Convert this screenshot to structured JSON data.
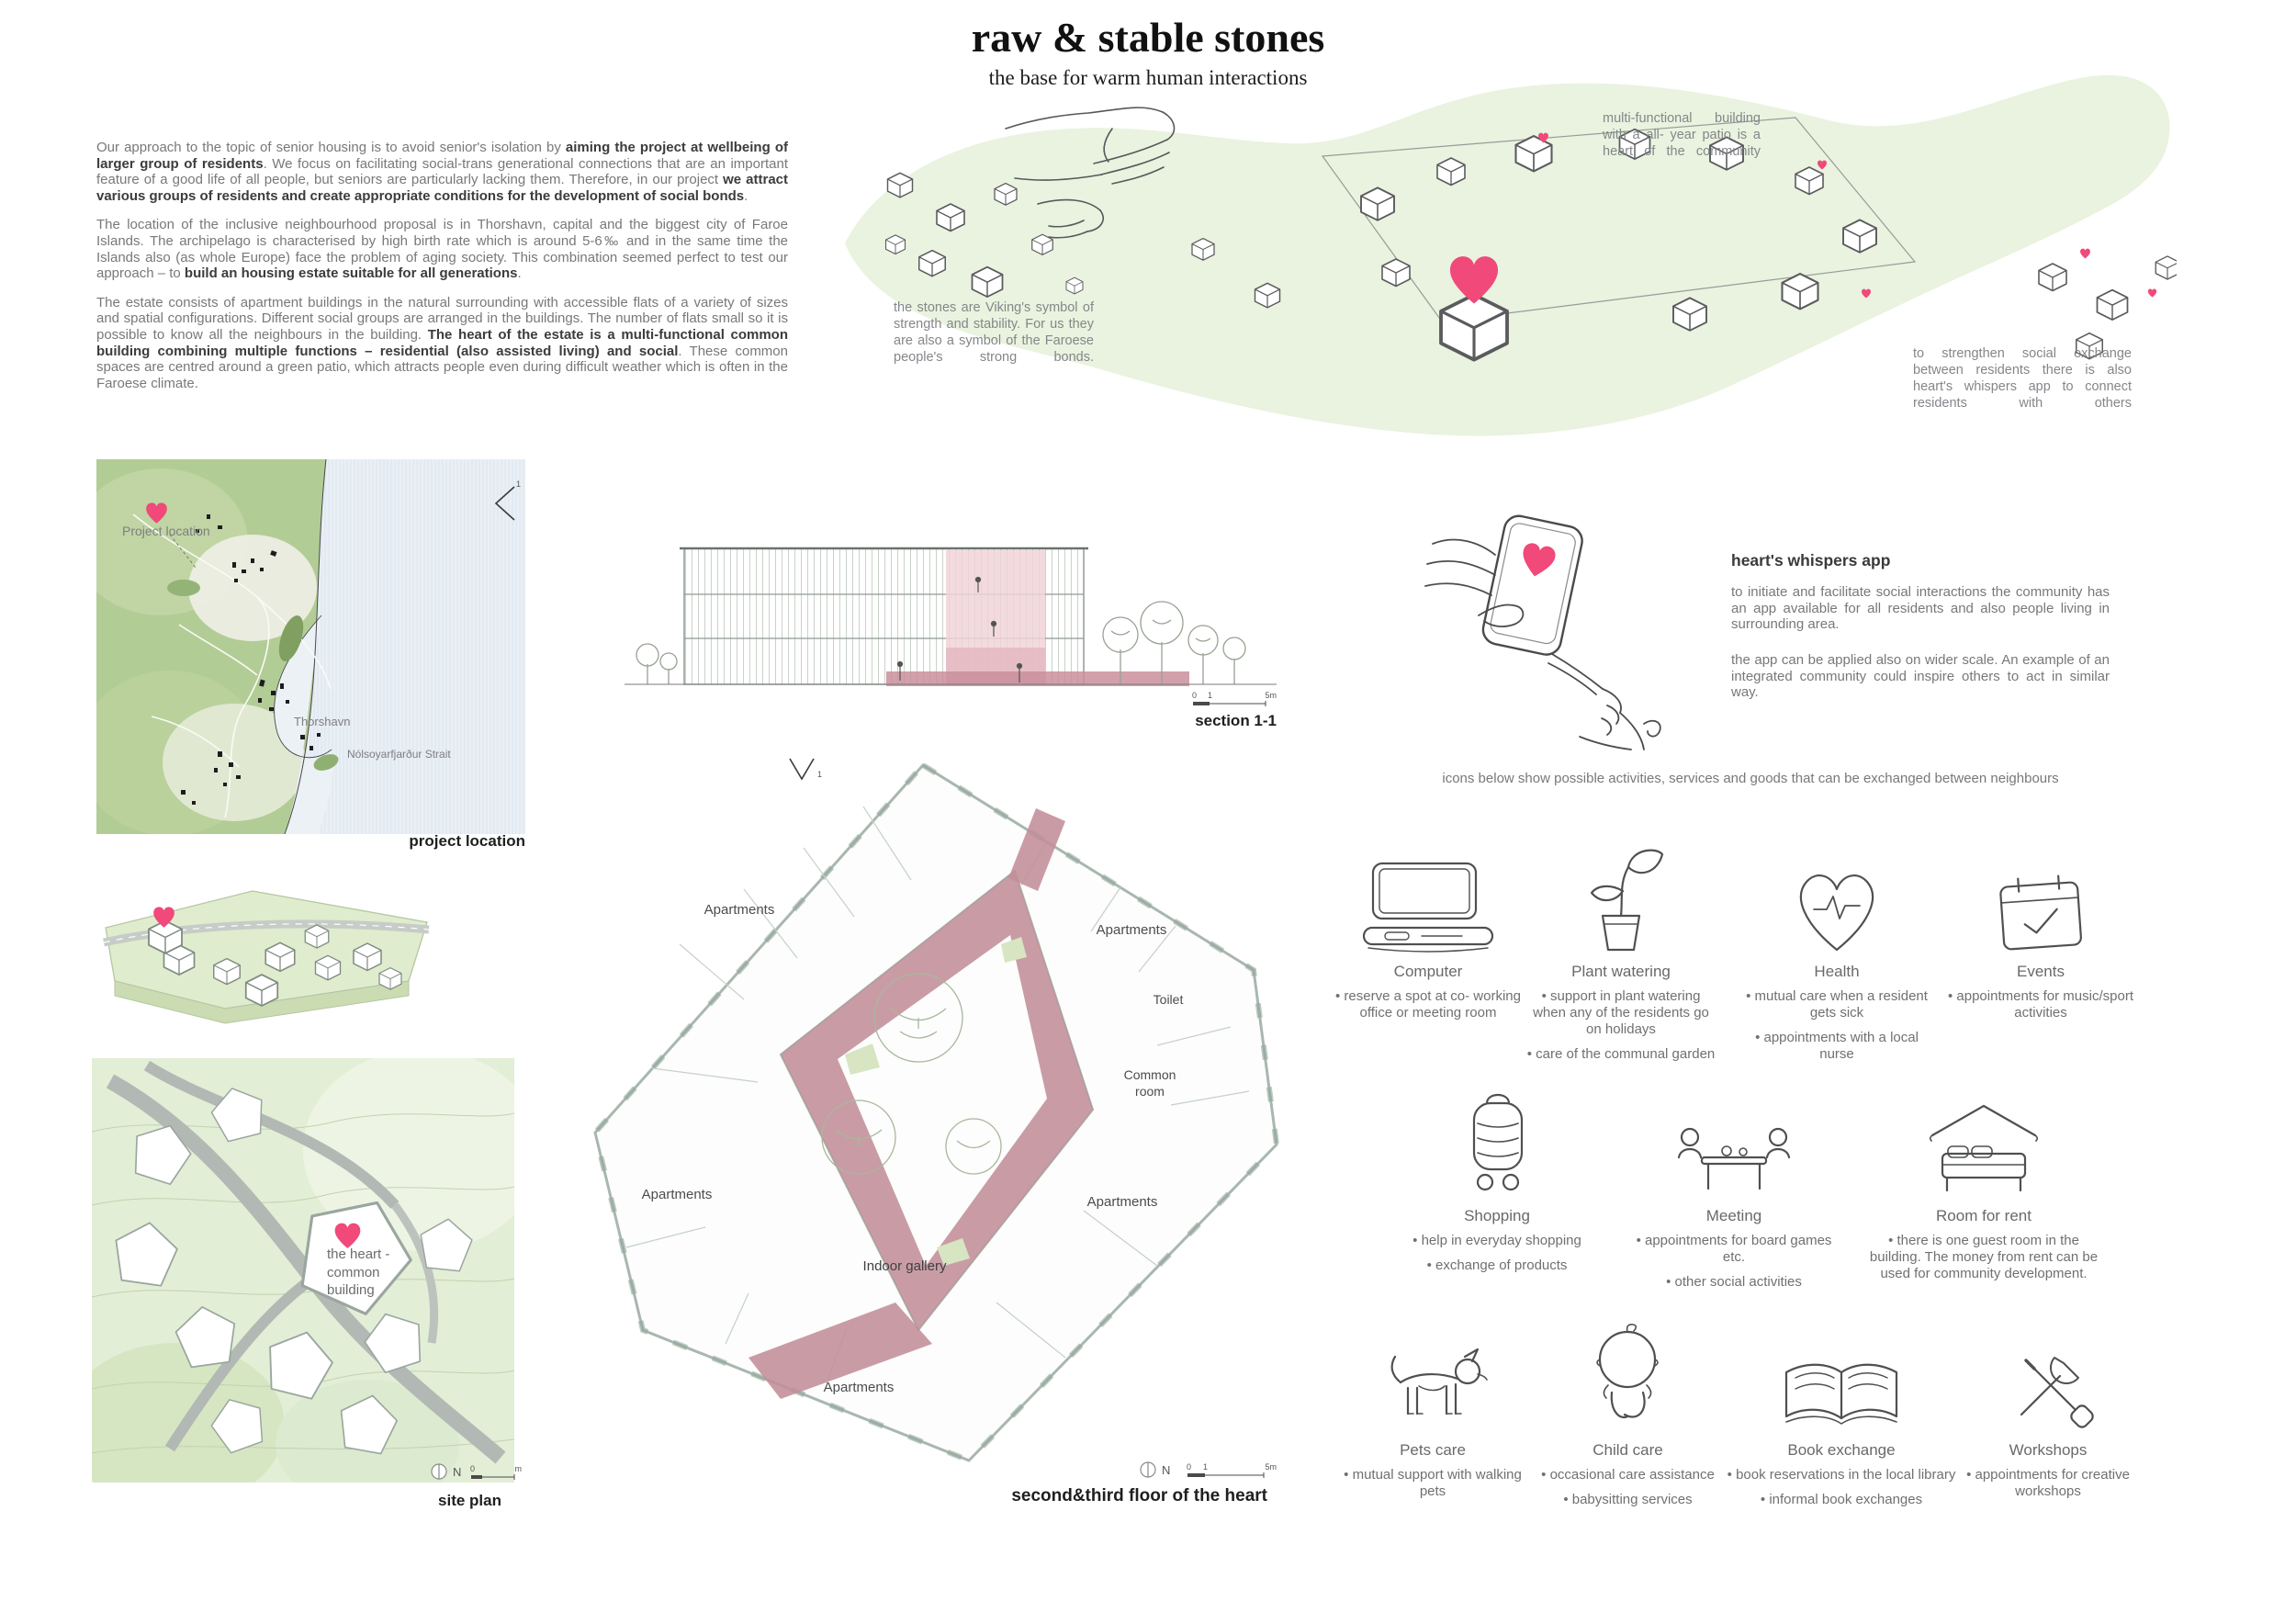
{
  "header": {
    "title": "raw & stable stones",
    "subtitle": "the base for warm human interactions"
  },
  "intro": {
    "p1": {
      "s0": "Our approach to the topic of senior housing is to avoid senior's isolation by ",
      "b1": "aiming the project at wellbeing of larger group of residents",
      "s2": ". We focus on facilitating social-trans generational connections that are an important feature of a good life of all people, but seniors are particularly lacking them. Therefore, in our project ",
      "b3": "we attract various groups of residents and create appropriate conditions for the development of social bonds",
      "s4": "."
    },
    "p2": {
      "s0": "The location of the inclusive neighbourhood proposal is in Thorshavn, capital and the biggest city of Faroe Islands. The archipelago is characterised by high birth rate which is around 5-6‰ and in the same time the Islands also (as whole Europe) face the problem of aging society. This combination seemed perfect to test our approach – to ",
      "b1": "build an housing estate suitable for all generations",
      "s2": "."
    },
    "p3": {
      "s0": "The estate consists of apartment buildings in the natural surrounding with accessible flats of a variety of sizes and spatial configurations. Different social groups are arranged in the buildings. The number of flats small so it is possible to know all the neighbours in the building. ",
      "b1": "The heart of the estate is a multi-functional common building combining multiple functions – residential (also assisted living) and social",
      "s2": ". These common spaces are centred around a green patio, which attracts people even during difficult weather which is often in the Faroese climate."
    }
  },
  "notes": {
    "building": "multi-functional building with a all- year patio is a heart of the community",
    "stones": "the stones are Viking's symbol of strength and stability. For us they are also a symbol of the Faroese people's strong bonds.",
    "app": "to strengthen social exchange between residents there is  also heart's whispers app to connect residents with others"
  },
  "location_map": {
    "labels": {
      "project_location": "Project location",
      "city": "Thorshavn",
      "strait": "Nólsoyarfjarður Strait"
    },
    "caption": "project location"
  },
  "section": {
    "caption": "section 1-1",
    "scale": {
      "zero": "0",
      "one": "1",
      "five": "5m"
    }
  },
  "site_plan": {
    "heart_label": "the heart - common building",
    "caption": "site plan",
    "north": "N",
    "scale": {
      "zero": "0",
      "unit": "m"
    }
  },
  "floor_plan": {
    "caption": "second&third floor of the heart",
    "north": "N",
    "cut_label": "1",
    "scale": {
      "zero": "0",
      "one": "1",
      "five": "5m"
    },
    "labels": {
      "apartments_top_left": "Apartments",
      "apartments_top_right": "Apartments",
      "toilet": "Toilet",
      "common_room": "Common room",
      "apartments_left": "Apartments",
      "apartments_right": "Apartments",
      "indoor_gallery": "Indoor gallery",
      "apartments_bottom": "Apartments"
    }
  },
  "app": {
    "heading": "heart's whispers app",
    "p1": "to initiate and facilitate social interactions the community has an app available for all residents and also people living in surrounding area.",
    "p2": "the app can be applied also on wider scale. An example of an integrated community could inspire others to act in similar way."
  },
  "exchange": {
    "intro": "icons below show possible activities, services and goods that can be exchanged between neighbours",
    "items": [
      {
        "icon": "computer-icon",
        "title": "Computer",
        "bullets": [
          "reserve a spot at co- working office or meeting room"
        ]
      },
      {
        "icon": "plant-watering-icon",
        "title": "Plant watering",
        "bullets": [
          "support in plant watering when any of the residents go on holidays",
          "care of the communal garden"
        ]
      },
      {
        "icon": "health-icon",
        "title": "Health",
        "bullets": [
          "mutual care when a resident gets sick",
          "appointments with a local nurse"
        ]
      },
      {
        "icon": "events-icon",
        "title": "Events",
        "bullets": [
          "appointments for music/sport activities"
        ]
      },
      {
        "icon": "shopping-icon",
        "title": "Shopping",
        "bullets": [
          "help in everyday shopping",
          "exchange of products"
        ]
      },
      {
        "icon": "meeting-icon",
        "title": "Meeting",
        "bullets": [
          "appointments for board games etc.",
          "other social activities"
        ]
      },
      {
        "icon": "room-for-rent-icon",
        "title": "Room for rent",
        "bullets": [
          "there is one guest room in the building. The money from rent can be used for community development."
        ]
      },
      {
        "icon": "pets-care-icon",
        "title": "Pets care",
        "bullets": [
          "mutual support with walking pets"
        ]
      },
      {
        "icon": "child-care-icon",
        "title": "Child care",
        "bullets": [
          "occasional care assistance",
          "babysitting services"
        ]
      },
      {
        "icon": "book-exchange-icon",
        "title": "Book exchange",
        "bullets": [
          "book reservations in the local library",
          "informal book exchanges"
        ]
      },
      {
        "icon": "workshops-icon",
        "title": "Workshops",
        "bullets": [
          "appointments for creative workshops"
        ]
      }
    ]
  },
  "colors": {
    "accent_pink": "#f0497a",
    "blob_green": "#e9f3df",
    "map_green": "#b2cc95",
    "plan_pink": "#c28e99",
    "body_text": "#77787a",
    "dark_text": "#3b3c3e"
  }
}
